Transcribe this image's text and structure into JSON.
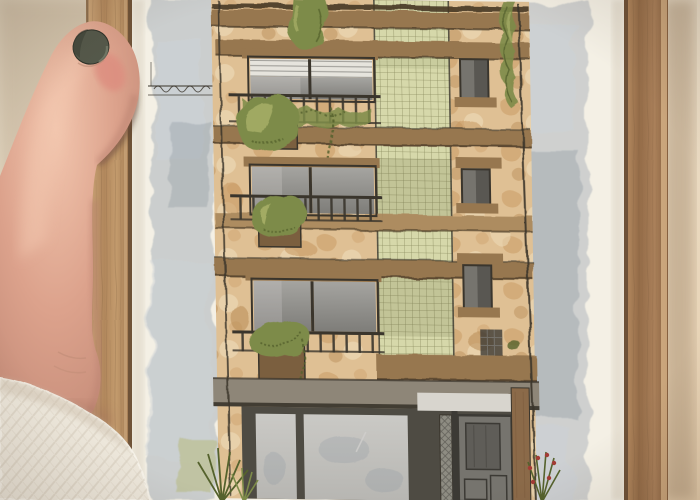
{
  "scene": {
    "type": "photograph",
    "description": "A hand with dark-polished thumbnail and a white knit sleeve holds a light oak wooden frame containing a watercolor illustration of a four-storey building facade: tan sponged stone, brown floor slabs, balconied windows with trailing plants, a green gridded lattice bay, small dark side windows, a gray glass storefront with a dark entry door, gray watercolor wash background on white paper.",
    "subject": "framed watercolor painting of a building held by a hand",
    "painting": {
      "floors_visible": 4,
      "elements": [
        "parapet-bands",
        "balcony-window-1",
        "balcony-window-2",
        "balcony-window-3",
        "lattice-grid-bay",
        "small-side-windows",
        "storefront-glazing",
        "entry-door",
        "planter-boxes",
        "trailing-vines",
        "climbing-vine",
        "utility-lines",
        "spiky-plant",
        "red-berry-plant",
        "gray-wash-sky"
      ]
    }
  },
  "palette": {
    "wall1": "#ddd1bb",
    "wall2": "#ece1cd",
    "wall3": "#e7cfae",
    "wallShadow": "#a78f72",
    "woodLa": "#cfa97c",
    "woodLb": "#b1875c",
    "woodLc": "#c39b6d",
    "woodLd": "#9f7750",
    "woodRa": "#b98e63",
    "woodRb": "#946c48",
    "woodRc": "#aa805a",
    "woodRd": "#86603f",
    "woodSeam": "#5e452f",
    "woodHi": "#d8b488",
    "grain": "#7b5a3c",
    "paper": "#f4f0e5",
    "paperShade": "#d9d0bf",
    "wash": "#aab2ba",
    "washLight": "#ccd1d6",
    "washDark": "#8d97a1",
    "stone": "#dfc094",
    "stoneB1": "#c79760",
    "stoneB2": "#eedcba",
    "stoneB3": "#b98d57",
    "slab": "#97774f",
    "slabHi": "#ad8c60",
    "slabDark": "#453824",
    "line": "#3a352c",
    "gridBase": "#d6d8aa",
    "gridLine": "#77794c",
    "gridDark": "#5c5f38",
    "glass": "#a5a4a0",
    "glassDark": "#7e7d79",
    "glassHi": "#cfcecb",
    "blind": "#e6e4dd",
    "storeGlass": "#b7b6b2",
    "storeGlassHi": "#cac9c5",
    "storeFrame": "#4e4b43",
    "entry": "#d8d5ce",
    "hatch": "#8e8c82",
    "door": "#76746e",
    "doorDark": "#3c3a35",
    "doorGlass": "#5f5d58",
    "woodCol": "#8b6a49",
    "awning": "#8e8678",
    "awningDark": "#423d33",
    "leaf": "#7d8b49",
    "leafDark": "#55622d",
    "leafLight": "#a9b069",
    "leafWash": "#b9bd85",
    "berry": "#a23b35",
    "skin": "#dca28c",
    "skinHi": "#f2c6ae",
    "skinShadow": "#b8806e",
    "skinDeep": "#9f6a59",
    "blush": "#dd8d7f",
    "nail": "#54584a",
    "nailDark": "#3c4035",
    "nailHi": "#7d8370",
    "crease": "#bb8a74",
    "sweater": "#ede7db",
    "sweaterLine": "#d6cdbd",
    "sweaterShade": "#c9bba8",
    "shadowWarm": "#4d3826",
    "frameGap": "#3c2a1c",
    "planterBox": "#7b5f3f"
  }
}
